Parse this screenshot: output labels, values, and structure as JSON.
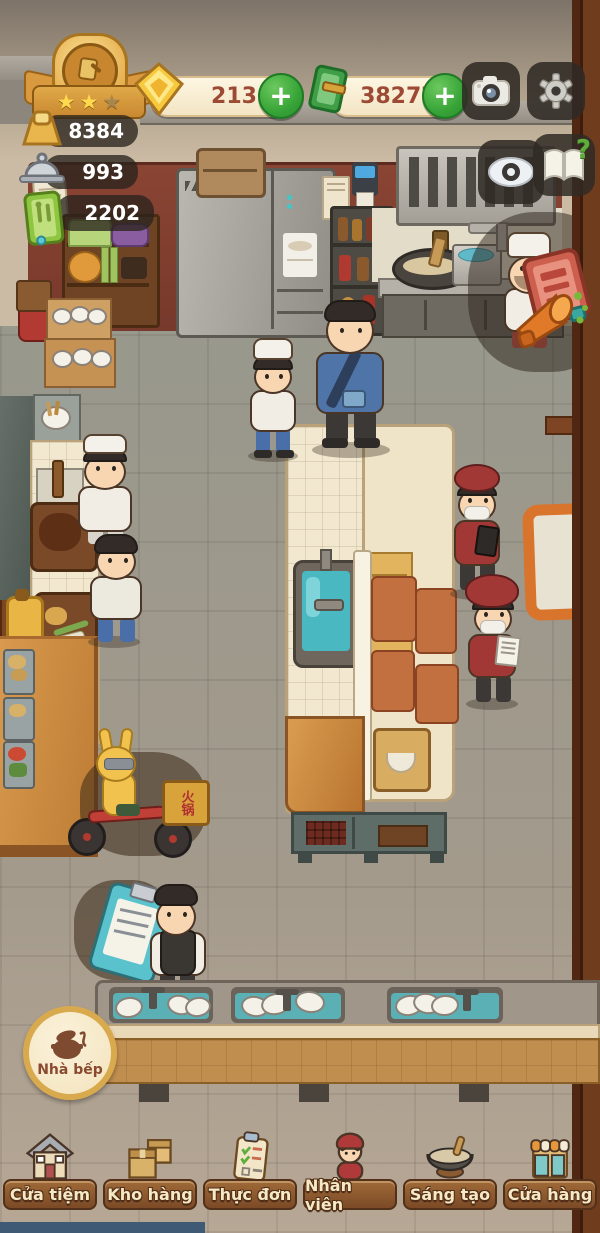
{
  "hud": {
    "level_badge": {
      "stars_lit": 2,
      "stars_total": 3,
      "star_glyph": "★"
    },
    "gems": {
      "value": "213"
    },
    "cash": {
      "value": "382779"
    },
    "plus_label": "+",
    "help_glyph": "?",
    "stats": [
      {
        "name": "gold-ingot",
        "value": "8384"
      },
      {
        "name": "dishes-served",
        "value": "993"
      },
      {
        "name": "menu-count",
        "value": "2202"
      }
    ]
  },
  "scene": {
    "room_badge_label": "Nhà bếp",
    "delivery_box_label": "火锅"
  },
  "nav": {
    "items": [
      {
        "id": "cua-tiem",
        "label": "Cửa tiệm"
      },
      {
        "id": "kho-hang",
        "label": "Kho hàng"
      },
      {
        "id": "thuc-don",
        "label": "Thực đơn"
      },
      {
        "id": "nhan-vien",
        "label": "Nhân viên"
      },
      {
        "id": "sang-tao",
        "label": "Sáng tạo"
      },
      {
        "id": "cua-hang",
        "label": "Cửa hàng"
      }
    ]
  },
  "icons": {
    "level_medal": "medal-icon",
    "gem": "gem-icon",
    "cash": "cash-icon",
    "camera": "camera-icon",
    "settings": "gear-icon",
    "eye": "eye-icon",
    "help": "help-book-icon",
    "recipe_book": "recipe-book-icon",
    "megaphone": "megaphone-icon",
    "gold_stat": "gold-ingot-icon",
    "dish_stat": "cloche-icon",
    "menu_stat": "menu-book-icon",
    "kitchen": "pot-icon"
  },
  "colors": {
    "accent_green": "#37a437",
    "gold": "#f2c14e",
    "pill_cream": "#f8edd3",
    "wood_brown": "#7b4a26",
    "red_wall": "#8a4433",
    "teal_water": "#53b4ba",
    "nav_label": "#f6e9c4",
    "currency_text": "#9c4a33"
  }
}
